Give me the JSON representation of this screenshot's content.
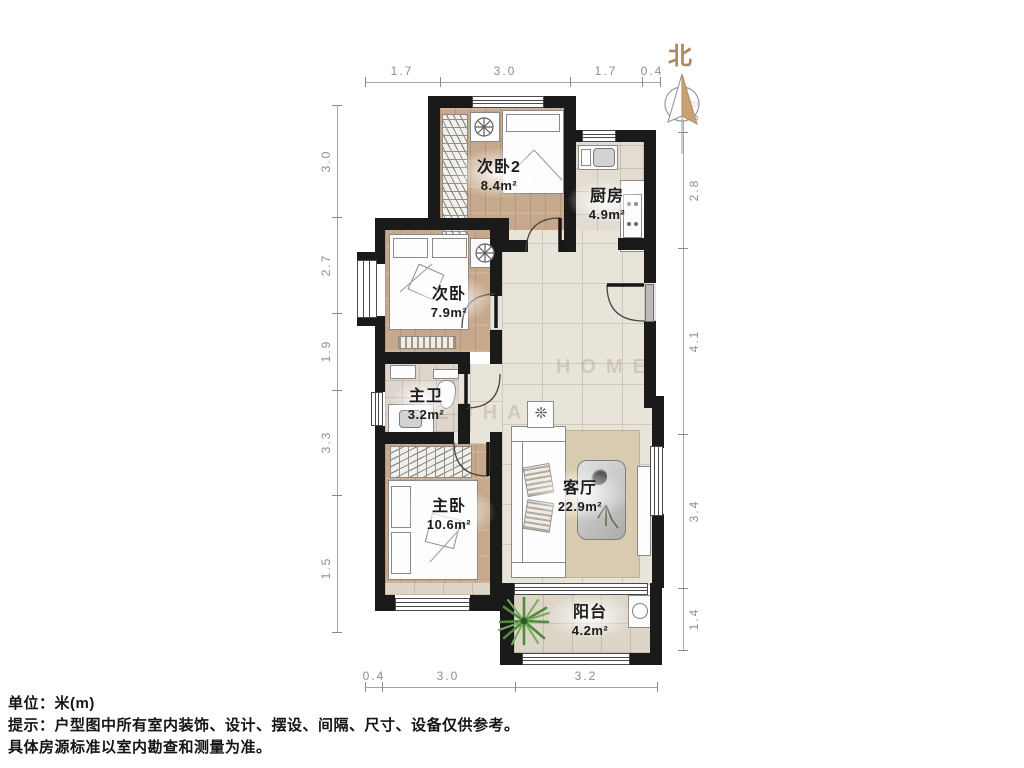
{
  "north": {
    "label": "北"
  },
  "rooms": {
    "bedroom2": {
      "name": "次卧2",
      "area": "8.4m²"
    },
    "kitchen": {
      "name": "厨房",
      "area": "4.9m²"
    },
    "bedroom": {
      "name": "次卧",
      "area": "7.9m²"
    },
    "master_bath": {
      "name": "主卫",
      "area": "3.2m²"
    },
    "master_bedroom": {
      "name": "主卧",
      "area": "10.6m²"
    },
    "living_room": {
      "name": "客厅",
      "area": "22.9m²"
    },
    "balcony": {
      "name": "阳台",
      "area": "4.2m²"
    }
  },
  "dimensions": {
    "top": [
      "1.7",
      "3.0",
      "1.7",
      "0.4"
    ],
    "left": [
      "3.0",
      "2.7",
      "1.9",
      "3.3",
      "1.5"
    ],
    "right": [
      "0.8",
      "2.8",
      "4.1",
      "3.4",
      "1.4"
    ],
    "bottom": [
      "0.4",
      "3.0",
      "3.2"
    ]
  },
  "watermark": {
    "row1": "HOME",
    "row2": "ZUHAO"
  },
  "icons": {
    "plant_table": "❊"
  },
  "footer": {
    "unit": "单位：米(m)",
    "tip1": "提示：户型图中所有室内装饰、设计、摆设、间隔、尺寸、设备仅供参考。",
    "tip2": "具体房源标准以室内勘查和测量为准。"
  },
  "colors": {
    "wall": "#1a1a1a",
    "wood_floor": "#c6a98c",
    "tile_floor": "#e9e4da",
    "north_accent": "#ad8a63"
  }
}
